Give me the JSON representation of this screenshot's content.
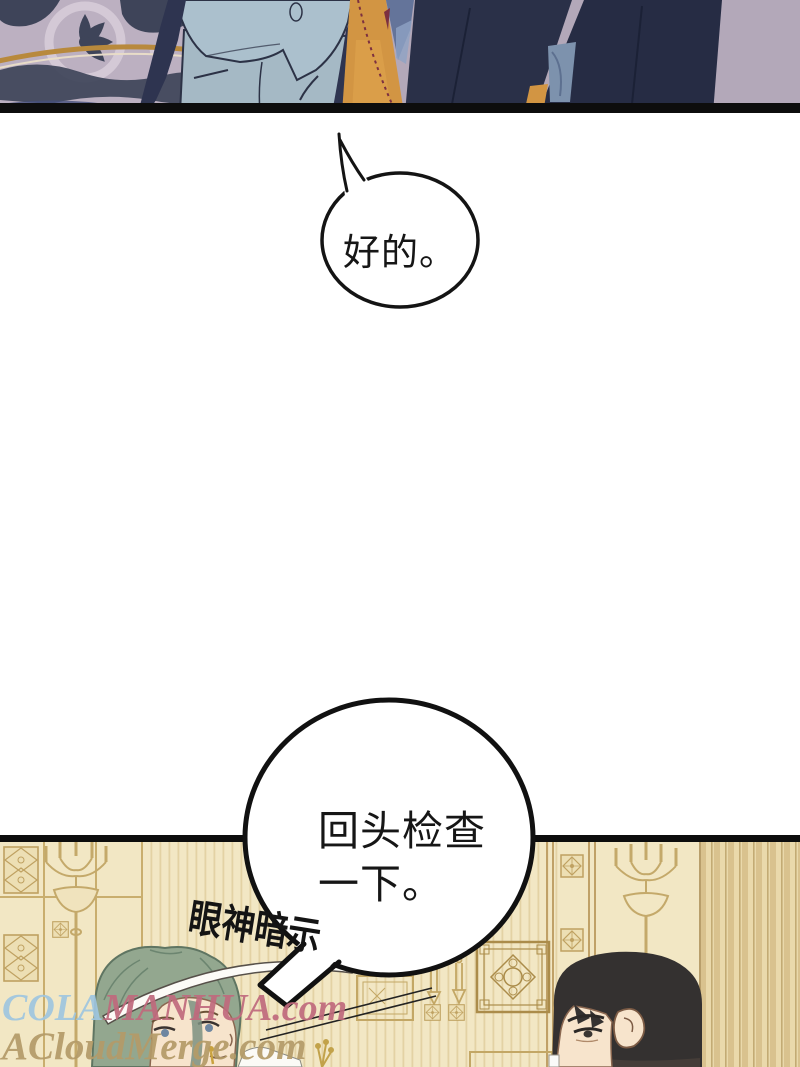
{
  "page": {
    "width": 800,
    "height": 1067,
    "background": "#ffffff"
  },
  "speech": {
    "ok_bubble": {
      "text": "好的。"
    },
    "check_bubble": {
      "line1": "回头检查",
      "line2": "一下。"
    }
  },
  "sfx": {
    "text": "眼神暗示"
  },
  "watermarks": {
    "primary_prefix": "COLA",
    "primary_main": "MANHUA.com",
    "secondary": "ACloudMerge.com"
  },
  "colors": {
    "panel_border": "#0d0d0d",
    "carpet_base": "#bcb0c1",
    "carpet_pattern": "#3e4459",
    "carpet_gold": "#b8893c",
    "suit_light": "#abc0cd",
    "trousers_light": "#a5b9c5",
    "floor_orange": "#d29543",
    "suit_dark": "#2a3048",
    "background_mauve": "#b3a8b9",
    "wall_cream": "#f2e7c4",
    "wall_gold": "#c3a765",
    "hair_green": "#93a78f",
    "hair_black": "#343130",
    "skin": "#f7e4cc",
    "watermark_blue": "#9fc6e0",
    "watermark_pink": "#c06a7d",
    "watermark_tan": "#b49b68"
  }
}
